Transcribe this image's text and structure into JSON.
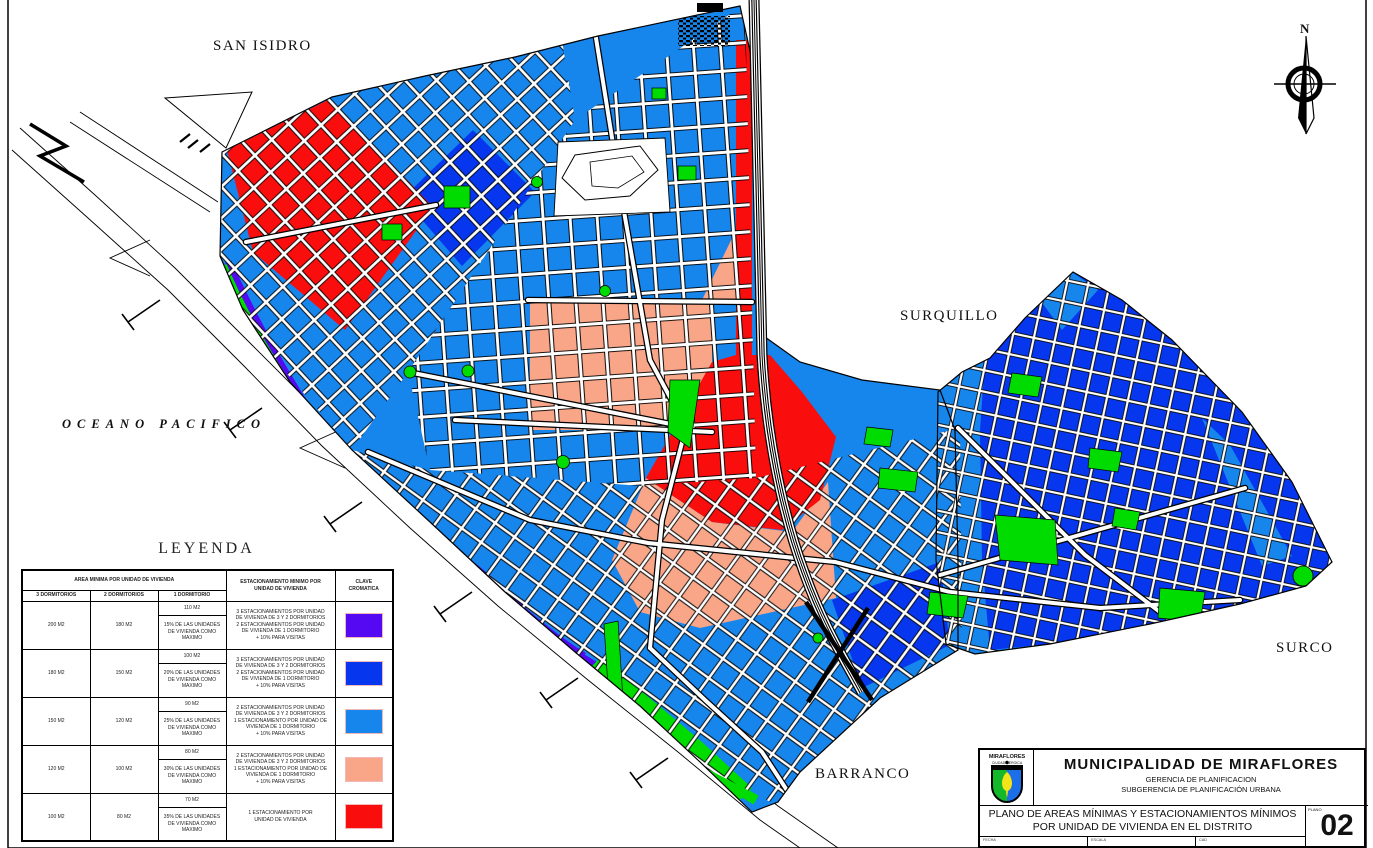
{
  "map": {
    "labels": {
      "san_isidro": "SAN ISIDRO",
      "surquillo": "SURQUILLO",
      "surco": "SURCO",
      "barranco": "BARRANCO",
      "ocean": "OCEANO PACIFICO",
      "north": "N"
    }
  },
  "colors": {
    "light_blue": "#1685EC",
    "dark_blue": "#0636EE",
    "pur": "#5509F2",
    "salmon": "#F8A588",
    "red": "#F90D0D",
    "green": "#00DC00",
    "street_white": "#FFFFFF",
    "line_black": "#000000"
  },
  "legend": {
    "title": "LEYENDA",
    "header": {
      "area": "AREA MINIMA POR UNIDAD DE VIVIENDA",
      "parking": "ESTACIONAMIENTO MINIMO POR\nUNIDAD DE VIVIENDA",
      "key": "CLAVE\nCROMATICA",
      "bed3": "3 DORMITORIOS",
      "bed2": "2 DORMITORIOS",
      "bed1": "1 DORMITORIO"
    },
    "rows": [
      {
        "d3": "200 M2",
        "d2": "180 M2",
        "d1_area": "110 M2",
        "d1_max": "15% DE LAS UNIDADES\nDE VIVIENDA COMO\nMAXIMO",
        "parking": "3 ESTACIONAMIENTOS POR UNIDAD\nDE VIVIENDA DE 3 Y 2 DORMITORIOS\n2 ESTACIONAMIENTOS POR UNIDAD\nDE VIVIENDA DE 1 DORMITORIO\n+ 10% PARA VISITAS",
        "color_key": "pur"
      },
      {
        "d3": "180 M2",
        "d2": "150 M2",
        "d1_area": "100 M2",
        "d1_max": "20% DE LAS UNIDADES\nDE VIVIENDA COMO\nMAXIMO",
        "parking": "3 ESTACIONAMIENTOS POR UNIDAD\nDE VIVIENDA DE 3 Y 2 DORMITORIOS\n2 ESTACIONAMIENTOS POR UNIDAD\nDE VIVIENDA DE 1 DORMITORIO\n+ 10% PARA VISITAS",
        "color_key": "dark_blue"
      },
      {
        "d3": "150 M2",
        "d2": "120 M2",
        "d1_area": "90 M2",
        "d1_max": "25% DE LAS UNIDADES\nDE VIVIENDA COMO\nMAXIMO",
        "parking": "2 ESTACIONAMIENTOS POR UNIDAD\nDE VIVIENDA DE 3 Y 2 DORMITORIOS\n1 ESTACIONAMIENTO POR UNIDAD DE\nVIVIENDA DE 1 DORMITORIO\n+ 10% PARA VISITAS",
        "color_key": "light_blue"
      },
      {
        "d3": "120 M2",
        "d2": "100 M2",
        "d1_area": "80 M2",
        "d1_max": "30% DE LAS UNIDADES\nDE VIVIENDA COMO\nMAXIMO",
        "parking": "2 ESTACIONAMIENTOS POR UNIDAD\nDE VIVIENDA DE 3 Y 2 DORMITORIOS\n1 ESTACIONAMIENTO POR UNIDAD DE\nVIVIENDA DE 1 DORMITORIO\n+ 10% PARA VISITAS",
        "color_key": "salmon"
      },
      {
        "d3": "100 M2",
        "d2": "80 M2",
        "d1_area": "70 M2",
        "d1_max": "35% DE LAS UNIDADES\nDE VIVIENDA COMO\nMAXIMO",
        "parking": "1 ESTACIONAMIENTO POR\nUNIDAD DE VIVIENDA",
        "color_key": "red"
      }
    ]
  },
  "titleblock": {
    "logo_line1": "MIRAFLORES",
    "logo_line2": "CIUDAD HEROICA",
    "org": "MUNICIPALIDAD  DE  MIRAFLORES",
    "dept": "GERENCIA DE PLANIFICACION",
    "subdept": "SUBGERENCIA DE PLANIFICACIÓN  URBANA",
    "title_line1": "PLANO DE AREAS MÍNIMAS  Y  ESTACIONAMIENTOS MÍNIMOS",
    "title_line2": "POR UNIDAD DE VIVIENDA EN EL DISTRITO",
    "plano_label": "PLANO",
    "plano_number": "02",
    "fields": {
      "fecha": "FECHA",
      "escala": "ESCALA",
      "cad": "CAD"
    }
  }
}
